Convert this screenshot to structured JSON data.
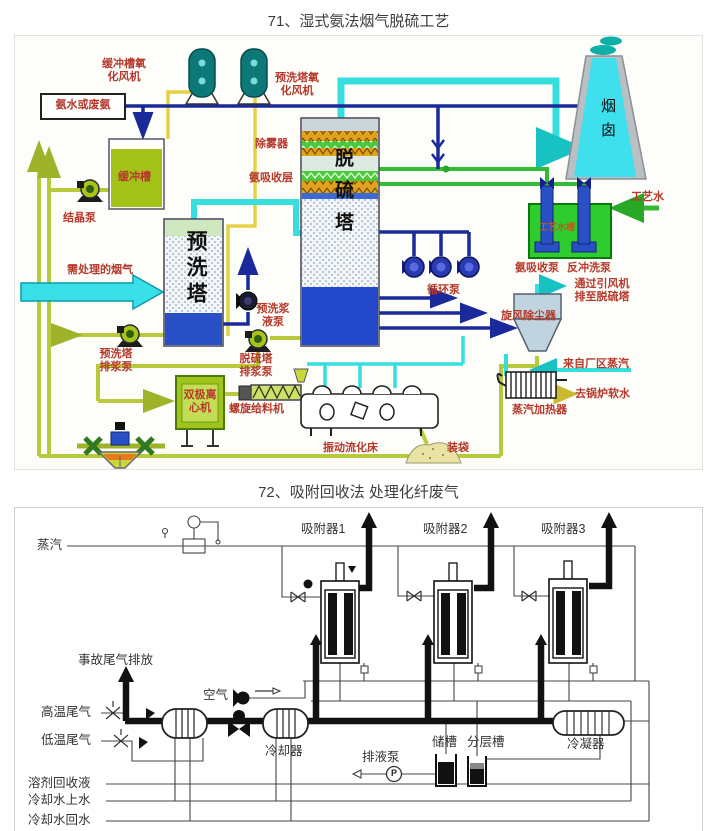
{
  "titles": {
    "t1": "71、湿式氨法烟气脱硫工艺",
    "t2": "72、吸附回收法 处理化纤废气"
  },
  "colors": {
    "label_red": "#b5392b",
    "pipe_navy": "#1a2a9a",
    "pipe_cyan": "#36dede",
    "pipe_green": "#33bb33",
    "pipe_olive": "#b9c93c",
    "pipe_yellow": "#e6d145",
    "tank_green": "#2ecc2e",
    "tower_blue": "#2a50c8",
    "chimney_cyan": "#3fe0ee"
  },
  "d1": {
    "labels": {
      "buffer_fan": "缓冲槽氧化风机",
      "ammonia_feed": "氨水或废氨",
      "buffer_tank": "缓冲槽",
      "crystal_pump": "结晶泵",
      "prewash_fan": "预洗塔氧化风机",
      "demister": "除雾器",
      "ammonia_absorb_layer": "氨吸收层",
      "flue_gas_in": "需处理的烟气",
      "prewash_tower": "预洗塔",
      "desulf_tower": "脱硫塔",
      "prewash_slurry_pump": "预洗浆液泵",
      "prewash_discharge_pump": "预洗塔排浆泵",
      "desulf_discharge_pump": "脱硫塔排浆泵",
      "circ_pump": "循环泵",
      "ammonia_absorb_pump": "氨吸收泵",
      "backwash_pump": "反冲洗泵",
      "cyclone": "旋风除尘器",
      "to_desulf": "通过引风机排至脱硫塔",
      "process_water": "工艺水",
      "process_water_tank": "工艺水槽",
      "chimney": "烟囱",
      "steam_from_plant": "来自厂区蒸汽",
      "to_boiler_water": "去锅炉软水",
      "steam_heater": "蒸汽加热器",
      "centrifuge": "双极离心机",
      "screw_feeder": "螺旋给料机",
      "fluidized_bed": "振动流化床",
      "bagging": "装袋"
    }
  },
  "d2": {
    "labels": {
      "steam": "蒸汽",
      "adsorber1": "吸附器1",
      "adsorber2": "吸附器2",
      "adsorber3": "吸附器3",
      "emergency_vent": "事故尾气排放",
      "hot_tail_gas": "高温尾气",
      "cold_tail_gas": "低温尾气",
      "air": "空气",
      "cooler": "冷却器",
      "drain_pump": "排液泵",
      "storage_tank": "储槽",
      "separation_tank": "分层槽",
      "condenser": "冷凝器",
      "solvent_recovery": "溶剂回收液",
      "cooling_water_supply": "冷却水上水",
      "cooling_water_return": "冷却水回水",
      "pump_symbol": "P"
    }
  }
}
